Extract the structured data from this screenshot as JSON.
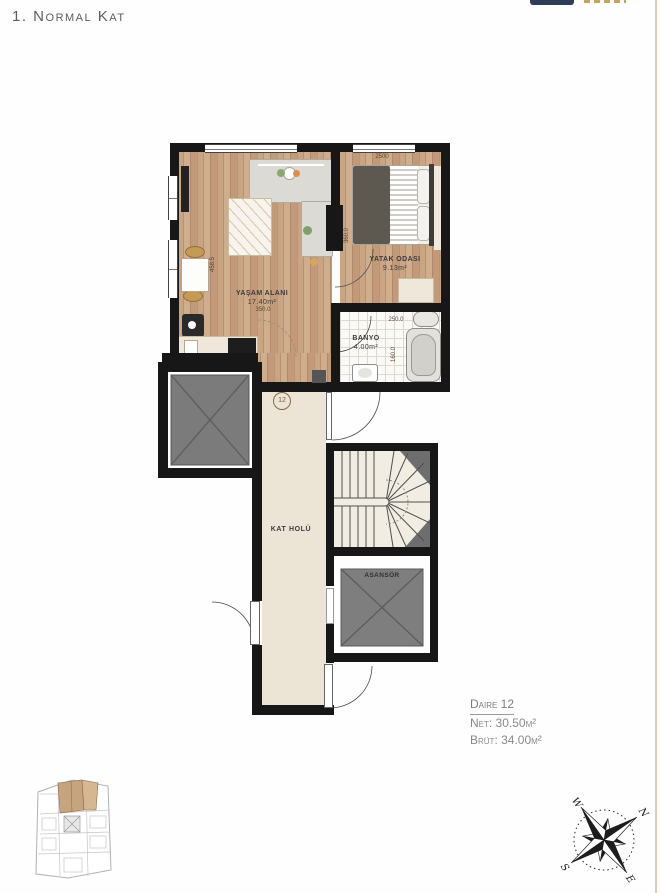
{
  "header": {
    "title": "1. Normal Kat"
  },
  "plan": {
    "rooms": {
      "living": {
        "name": "YAŞAM ALANI",
        "area": "17.40m²",
        "dim": "350.0"
      },
      "bedroom": {
        "name": "YATAK ODASI",
        "area": "9.13m²"
      },
      "bathroom": {
        "name": "BANYO",
        "area": "4.00m²"
      },
      "hall": {
        "name": "KAT HOLÜ"
      },
      "elevator": {
        "name": "ASANSÖR"
      }
    },
    "unit_number": "12",
    "dims": {
      "bedroom_width": "2500",
      "bedroom_depth": "360.0",
      "living_depth": "458.5",
      "bath_width": "250.0",
      "bath_depth": "160.0"
    }
  },
  "info": {
    "unit": "Daire 12",
    "net": "Net: 30.50m²",
    "brut": "Brüt: 34.00m²"
  },
  "compass": {
    "n": "N",
    "e": "E",
    "s": "S",
    "w": "W"
  },
  "colors": {
    "wall": "#171717",
    "wood": "#c29c7c",
    "hall_floor": "#ece4d4",
    "shaft_gray": "#7b7b7b",
    "highlight_tan": "#c6a47e",
    "accent_navy": "#2e3d56",
    "accent_gold": "#c9a35c"
  }
}
